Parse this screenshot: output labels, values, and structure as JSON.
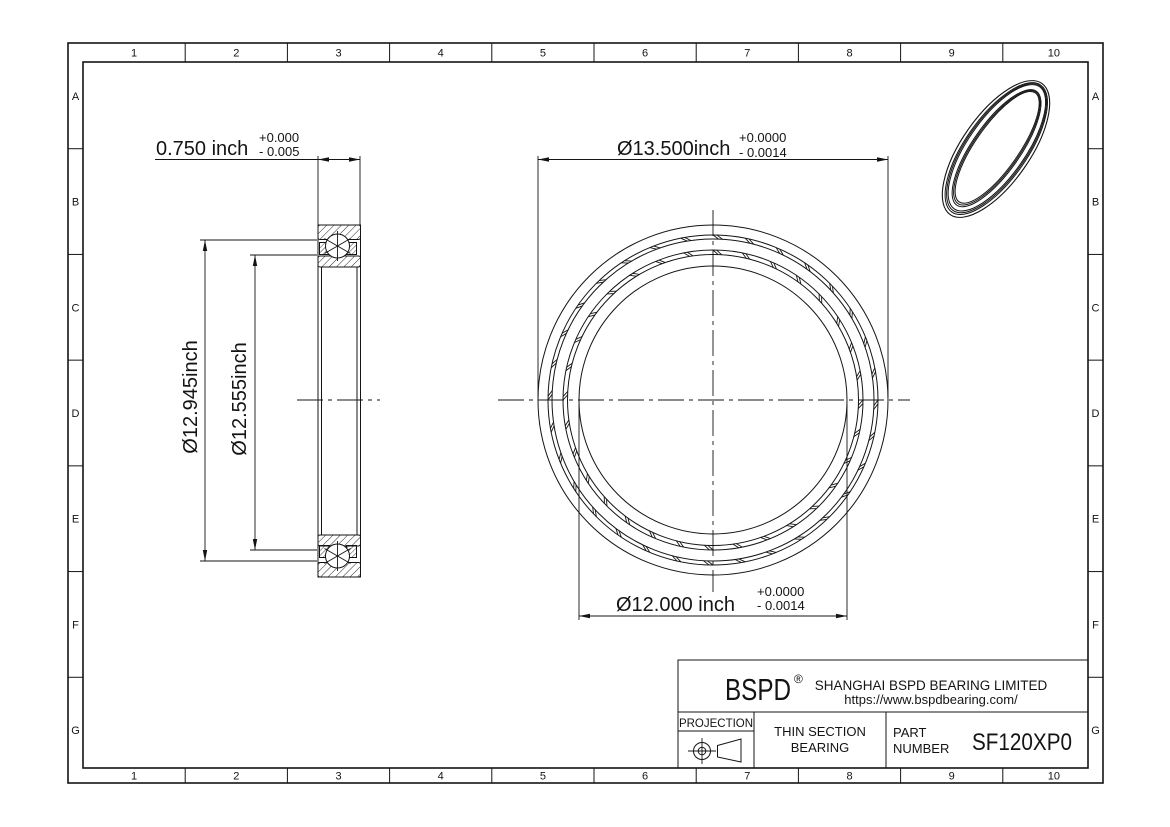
{
  "frame": {
    "columns": [
      "1",
      "2",
      "3",
      "4",
      "5",
      "6",
      "7",
      "8",
      "9",
      "10"
    ],
    "rows": [
      "A",
      "B",
      "C",
      "D",
      "E",
      "F",
      "G"
    ]
  },
  "dimensions": {
    "width": {
      "value": "0.750 inch",
      "tol_plus": "+0.000",
      "tol_minus": "- 0.005"
    },
    "outer_dia": {
      "value": "Ø13.500inch",
      "tol_plus": "+0.0000",
      "tol_minus": "- 0.0014"
    },
    "bore_dia": {
      "value": "Ø12.000 inch",
      "tol_plus": "+0.0000",
      "tol_minus": "- 0.0014"
    },
    "outer_race": {
      "value": "Ø12.945inch"
    },
    "inner_race": {
      "value": "Ø12.555inch"
    }
  },
  "front_view": {
    "center_x": 713,
    "center_y": 400,
    "circle_radii": [
      175,
      165,
      161,
      150,
      145.5,
      134
    ],
    "ball_bands": [
      [
        165,
        161
      ],
      [
        150,
        145.5
      ]
    ],
    "segments": 32
  },
  "title_block": {
    "logo": "BSPD",
    "registered": "®",
    "company": "SHANGHAI BSPD BEARING LIMITED",
    "website": "https://www.bspdbearing.com/",
    "projection_label": "PROJECTION",
    "product_line1": "THIN SECTION",
    "product_line2": "BEARING",
    "part_label_line1": "PART",
    "part_label_line2": "NUMBER",
    "part_number": "SF120XP0"
  },
  "colors": {
    "line": "#141414",
    "background": "#ffffff"
  }
}
